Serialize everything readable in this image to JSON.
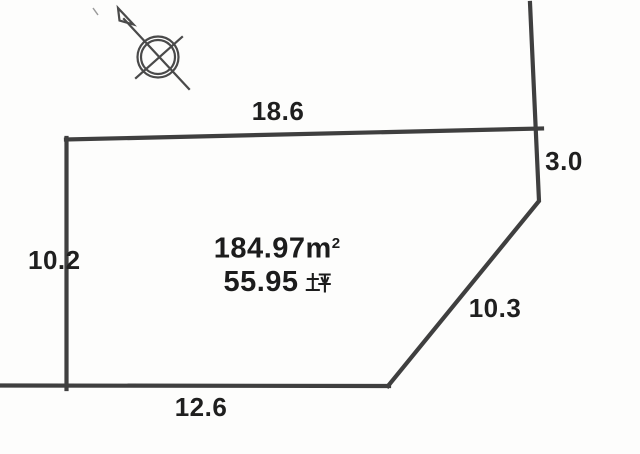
{
  "diagram": {
    "kind": "land-plot-survey-drawing",
    "area": {
      "sqm_label": "184.97㎡",
      "sqm_value": "184.97",
      "sqm_unit_base": "m",
      "sqm_unit_exp": "2",
      "tsubo_label": "55.95坪",
      "tsubo_value": "55.95",
      "tsubo_unit": "坪"
    },
    "dimensions": {
      "top": "18.6",
      "right_upper": "3.0",
      "right_diagonal": "10.3",
      "bottom": "12.6",
      "left": "10.2"
    },
    "symbols": {
      "north_arrow": "compass-north-needle"
    },
    "colors": {
      "boundary_line": "#3f3f3f",
      "text": "#1f1f1f",
      "background": "#fdfdfc"
    }
  }
}
